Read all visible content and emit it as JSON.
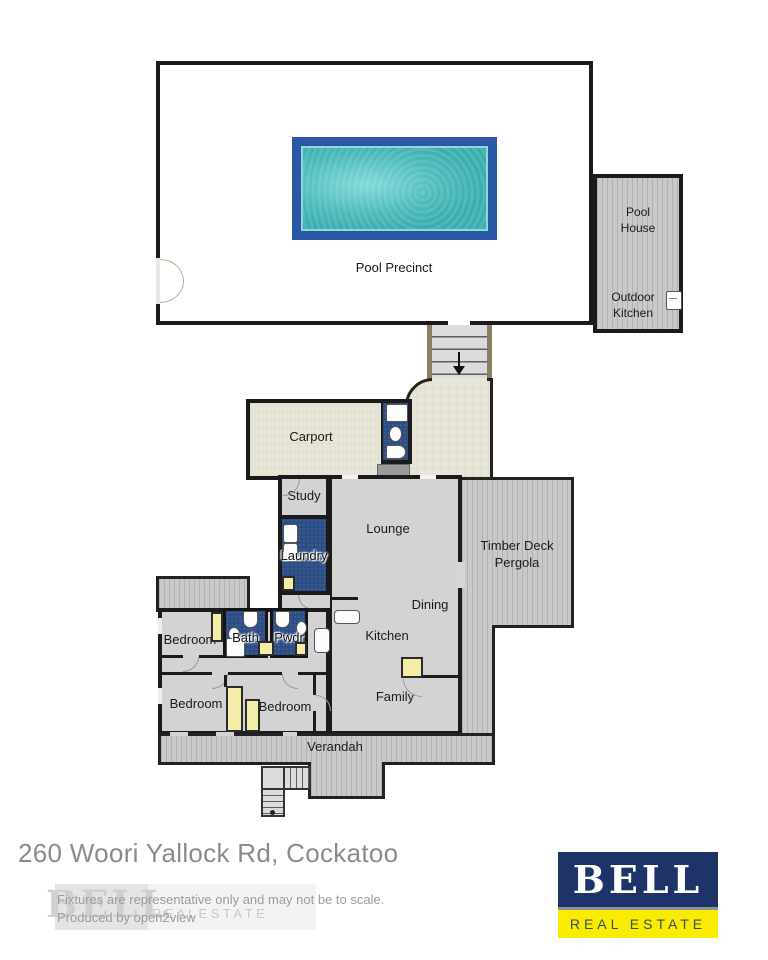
{
  "address": "260 Woori Yallock Rd, Cockatoo",
  "disclaimer": {
    "line1": "Fixtures are representative only and may not be to scale.",
    "line2": "Produced by open2view"
  },
  "watermark": {
    "name": "BELL",
    "tagline": "R E A L    E S T A T E"
  },
  "logo": {
    "name": "BELL",
    "tagline": "REAL ESTATE"
  },
  "rooms": {
    "pool_precinct": "Pool Precinct",
    "pool_house": "Pool House",
    "outdoor_kitchen": "Outdoor Kitchen",
    "carport": "Carport",
    "study": "Study",
    "laundry": "Laundry",
    "lounge": "Lounge",
    "timber_deck": "Timber Deck Pergola",
    "dining": "Dining",
    "kitchen": "Kitchen",
    "family": "Family",
    "bath": "Bath",
    "powder": "Pwdr",
    "bedroom_1": "Bedroom",
    "bedroom_2": "Bedroom",
    "bedroom_3": "Bedroom",
    "verandah": "Verandah"
  },
  "colors": {
    "wall": "#1b1b1b",
    "room_gray": "#d3d3d3",
    "wet_area_navy": "#2d4d85",
    "outdoor_beige": "#e7e5d6",
    "deck_gray": "#c9c9c9",
    "pool_water_teal": "#3fb1b1",
    "pool_border_navy": "#2b57a7",
    "cabinet_yellow": "#f3eda8",
    "logo_navy": "#1e3468",
    "logo_yellow": "#f9ec00",
    "title_gray": "#8b8b8b"
  }
}
